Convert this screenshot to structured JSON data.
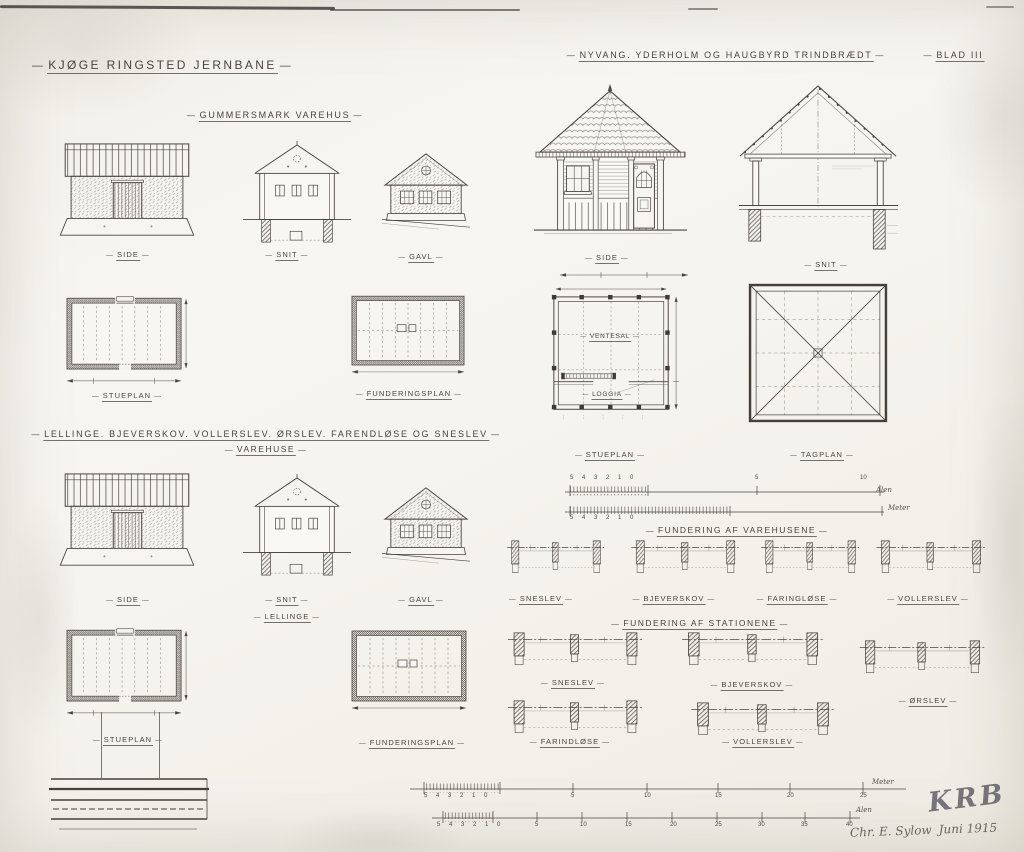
{
  "deco": {
    "dash": "—"
  },
  "header": {
    "main_title": "KJØGE RINGSTED JERNBANE",
    "sheet_label": "BLAD III"
  },
  "sections": {
    "gummersmark": {
      "title": "GUMMERSMARK VAREHUS",
      "side": "SIDE",
      "snit": "SNIT",
      "gavl": "GAVL",
      "stueplan": "STUEPLAN",
      "funderingsplan": "FUNDERINGSPLAN"
    },
    "nyvang": {
      "title": "NYVANG. YDERHOLM OG HAUGBYRD TRINDBRÆDT",
      "side": "SIDE",
      "snit": "SNIT",
      "stueplan": "STUEPLAN",
      "tagplan": "TAGPLAN",
      "ventesal": "VENTESAL",
      "loggia": "LOGGIA"
    },
    "lellinge": {
      "title": "LELLINGE. BJEVERSKOV. VOLLERSLEV. ØRSLEV. FARENDLØSE OG SNESLEV",
      "subtitle": "VAREHUSE",
      "side": "SIDE",
      "snit": "SNIT",
      "name": "LELLINGE",
      "gavl": "GAVL",
      "stueplan": "STUEPLAN",
      "funderingsplan": "FUNDERINGSPLAN"
    },
    "fundering_varehusene": {
      "title": "FUNDERING AF VAREHUSENE",
      "items": [
        "SNESLEV",
        "BJEVERSKOV",
        "FARINGLØSE",
        "VOLLERSLEV"
      ]
    },
    "fundering_stationene": {
      "title": "FUNDERING AF STATIONENE",
      "row1": [
        "SNESLEV",
        "BJEVERSKOV",
        "ØRSLEV"
      ],
      "row2": [
        "FARINDLØSE",
        "VOLLERSLEV"
      ]
    }
  },
  "scales": {
    "mid_upper": {
      "cluster": "5 4 3 2 1 0",
      "m5": "5",
      "m10": "10",
      "unit": "Alen"
    },
    "mid_lower": {
      "cluster": "5 4 3 2 1 0",
      "unit": "Meter"
    },
    "bottom_upper": {
      "cluster": "5 4 3 2 1 0",
      "marks": [
        "5",
        "10",
        "15",
        "20",
        "25"
      ],
      "unit": "Meter"
    },
    "bottom_lower": {
      "cluster": "5 4 3 2 1 0",
      "marks": [
        "5",
        "10",
        "15",
        "20",
        "25",
        "30",
        "35",
        "40"
      ],
      "unit": "Alen"
    }
  },
  "signature": {
    "initials": "KRB",
    "name": "Chr. E. Sylow",
    "date": "Juni 1915"
  }
}
